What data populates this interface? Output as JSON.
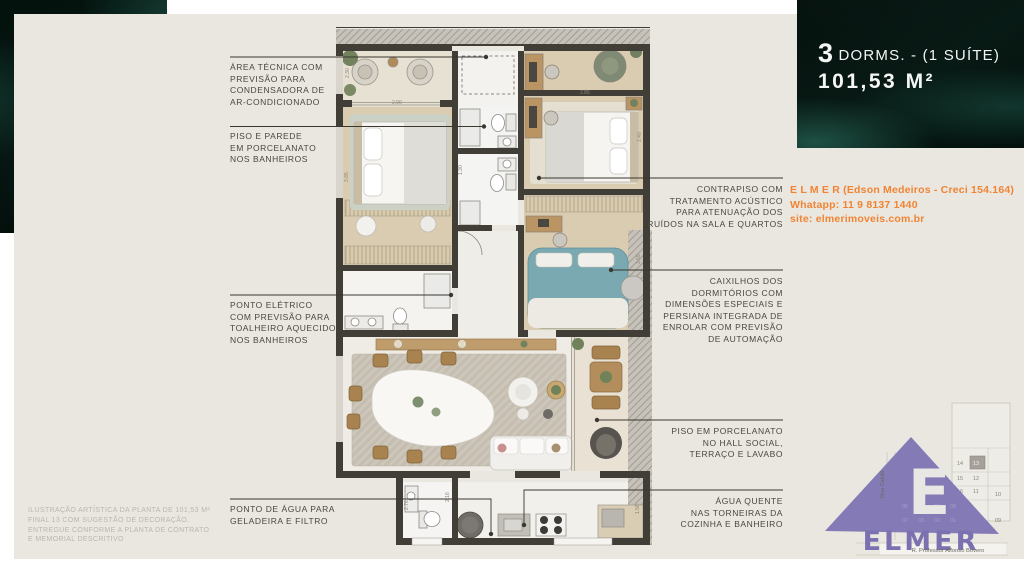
{
  "page": {
    "card_bg": "#EAE7E1",
    "accent_orange": "#F08433",
    "brand_purple": "#837AB6",
    "wall_color": "#413D37"
  },
  "header": {
    "dorms_number": "3",
    "dorms_label": "DORMS. - (1 SUÍTE)",
    "area": "101,53 M²"
  },
  "contact": {
    "line1": "E L M E R (Edson Medeiros - Creci 154.164)",
    "line2": "Whatapp: 11 9 8137 1440",
    "line3": "site: elmerimoveis.com.br"
  },
  "annotations": {
    "left": [
      {
        "lines": [
          "ÁREA TÉCNICA COM",
          "PREVISÃO PARA",
          "CONDENSADORA DE",
          "AR-CONDICIONADO"
        ]
      },
      {
        "lines": [
          "PISO E PAREDE",
          "EM PORCELANATO",
          "NOS BANHEIROS"
        ]
      },
      {
        "lines": [
          "PONTO ELÉTRICO",
          "COM PREVISÃO PARA",
          "TOALHEIRO AQUECIDO",
          "NOS BANHEIROS"
        ]
      },
      {
        "lines": [
          "PONTO DE ÁGUA PARA",
          "GELADEIRA E FILTRO"
        ]
      }
    ],
    "right": [
      {
        "lines": [
          "CONTRAPISO COM",
          "TRATAMENTO ACÚSTICO",
          "PARA ATENUAÇÃO DOS",
          "RUÍDOS NA SALA E QUARTOS"
        ]
      },
      {
        "lines": [
          "CAIXILHOS DOS",
          "DORMITÓRIOS COM",
          "DIMENSÕES ESPECIAIS E",
          "PERSIANA INTEGRADA DE",
          "ENROLAR COM PREVISÃO",
          "DE AUTOMAÇÃO"
        ]
      },
      {
        "lines": [
          "PISO EM PORCELANATO",
          "NO HALL SOCIAL,",
          "TERRAÇO E LAVABO"
        ]
      },
      {
        "lines": [
          "ÁGUA QUENTE",
          "NAS TORNEIRAS DA",
          "COZINHA E BANHEIRO"
        ]
      }
    ]
  },
  "disclaimer": {
    "lines": [
      "ILUSTRAÇÃO ARTÍSTICA DA PLANTA DE 101,53 M²",
      "FINAL 13 COM SUGESTÃO DE DECORAÇÃO.",
      "ENTREGUE CONFORME A PLANTA DE CONTRATO",
      "E MEMORIAL DESCRITIVO"
    ]
  },
  "plan": {
    "dims": [
      "2.30",
      "2.90",
      "2.85",
      "2.40",
      "1.30",
      "3.85",
      "3.55",
      "2.16",
      "2.76",
      "1.56"
    ]
  },
  "keyplan": {
    "units": [
      "14",
      "13",
      "15",
      "12",
      "16",
      "11",
      "10",
      "05",
      "04",
      "06",
      "08",
      "07",
      "03",
      "02",
      "01",
      "09"
    ],
    "highlight": "13",
    "street_vertical": "Rua Caiubi",
    "street_horizontal": "R. Professor Alfonso Bovero"
  },
  "logo": {
    "letter": "E",
    "brand": "ELMER"
  }
}
